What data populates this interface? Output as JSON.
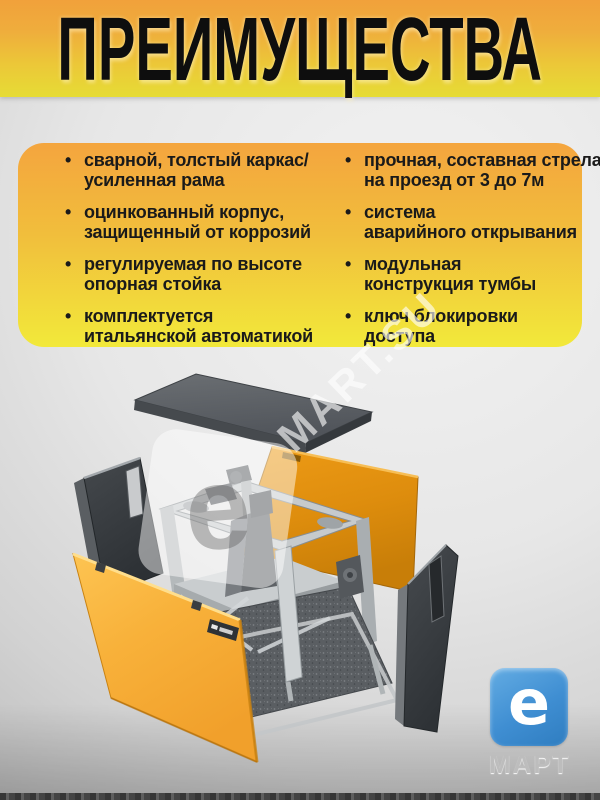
{
  "header": {
    "title": "ПРЕИМУЩЕСТВА"
  },
  "advantages": {
    "left": [
      "сварной, толстый каркас/\nусиленная рама",
      "оцинкованный корпус,\nзащищенный от коррозий",
      "регулируемая по высоте\nопорная стойка",
      "комплектуется\nитальянской автоматикой"
    ],
    "right": [
      "прочная, составная стрела\nна проезд от 3 до 7м",
      "система\nаварийного открывания",
      "модульная\nконструкция тумбы",
      "ключ блокировки\nдоступа"
    ]
  },
  "watermark": {
    "logo_glyph": "e",
    "text": "MART.SU"
  },
  "brand_logo": {
    "glyph": "e",
    "label": "МАРТ",
    "color": "#3F8ED2"
  },
  "colors": {
    "header_gradient_top": "#F1A13B",
    "header_gradient_bottom": "#E6DC35",
    "card_gradient_top": "#F4A53E",
    "card_gradient_bottom": "#F2E93A",
    "door_orange": "#F8B13A",
    "rear_door_orange": "#E08E0E",
    "panel_dark_gray": "#3A3E41",
    "frame_gray": "#C6CACC",
    "lid_gray": "#5E6266"
  }
}
